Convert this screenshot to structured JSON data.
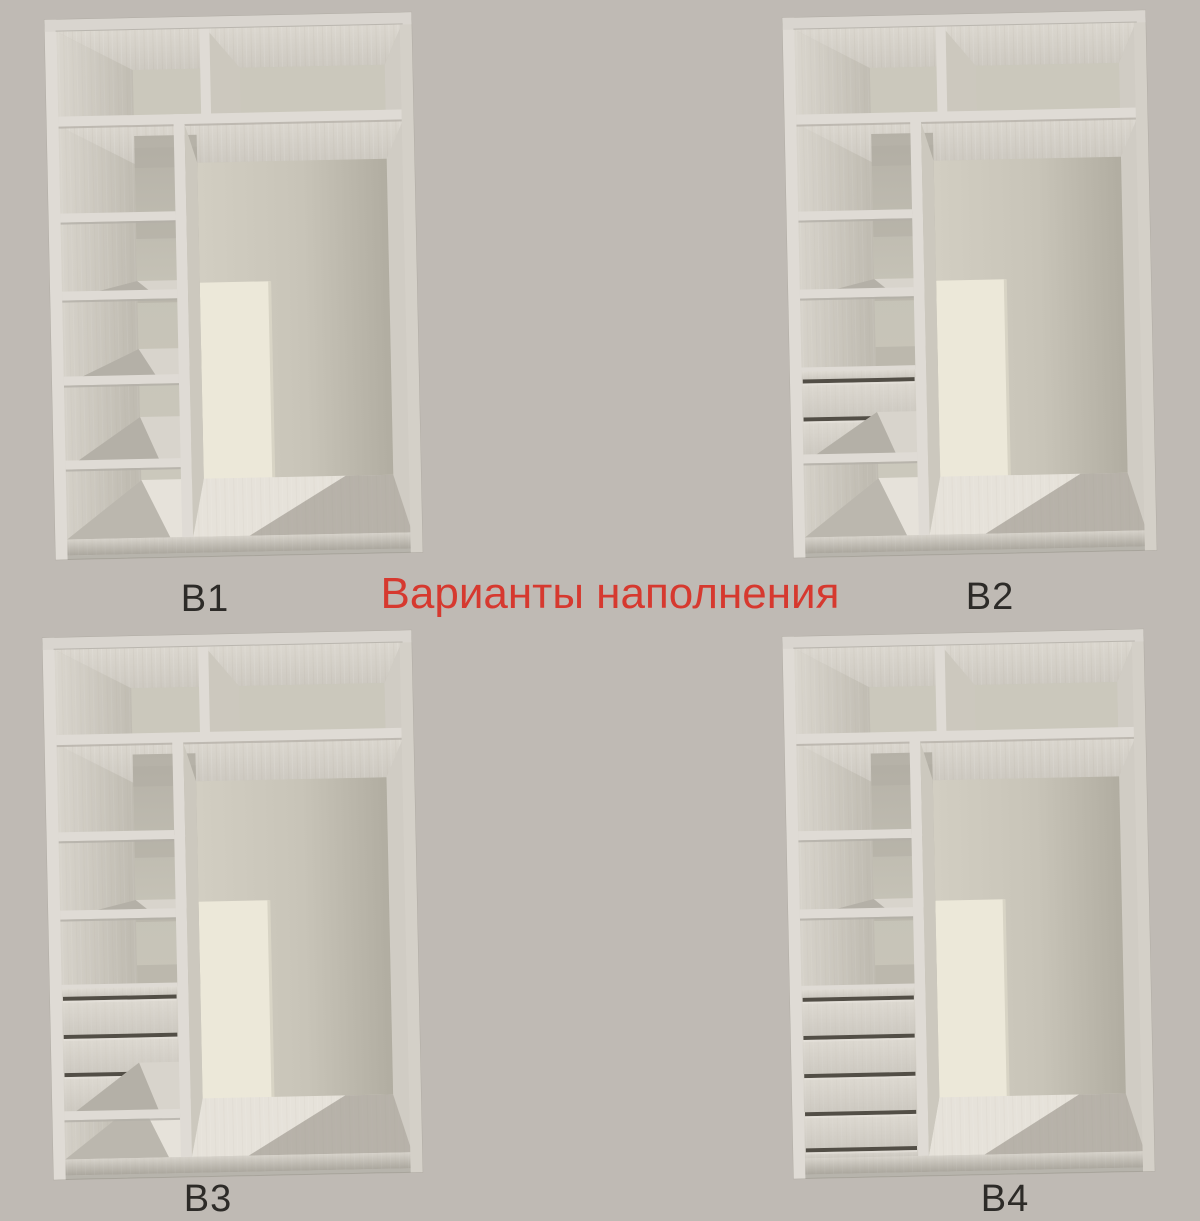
{
  "background": "#bfbab4",
  "title": {
    "text": "Варианты наполнения",
    "color": "#d6392f"
  },
  "label_color": "#2d2b28",
  "palette": {
    "frame": "#d9d5cf",
    "frame_light": "#dfdbd5",
    "frame_edge": "#b0aca4",
    "interior_back": "#c7c4b8",
    "back_top": "#cbc8bc",
    "compartment_back": "#c6c3b7",
    "ceiling_light": "#dbd7cf",
    "ceiling_dark": "#cfcbc3",
    "left_wall_light": "#d8d4cc",
    "left_wall_dark": "#c3bfb5",
    "right_wall": "#d0ccc4",
    "side_face": "#ccc8be",
    "back_right_light": "#d2cec2",
    "back_right_dark": "#b1ada1",
    "panel_cream": "#ece8d9",
    "panel_edge": "#d8d4c5",
    "floor": "#e6e2da",
    "shadow": "#8f8b81",
    "drawer_gap": "#524e46",
    "under_shelf": "#b0aca2",
    "surface": "#d8d4cc"
  },
  "variants": [
    {
      "id": "v1",
      "label": "В1",
      "shelves": [
        200,
        278,
        363,
        447
      ],
      "drawer_block": null
    },
    {
      "id": "v2",
      "label": "В2",
      "shelves": [
        200,
        278
      ],
      "drawer_block": {
        "top": 360,
        "gaps": [
          368,
          406
        ],
        "bottom": 443,
        "shelf_below": true
      }
    },
    {
      "id": "v3",
      "label": "В3",
      "shelves": [
        200,
        278
      ],
      "drawer_block": {
        "top": 356,
        "gaps": [
          364,
          402,
          440
        ],
        "bottom": 478,
        "shelf_below": true
      }
    },
    {
      "id": "v4",
      "label": "В4",
      "shelves": [
        200,
        278
      ],
      "drawer_block": {
        "top": 358,
        "gaps": [
          366,
          404,
          442,
          480,
          516
        ],
        "bottom": 526,
        "shelf_below": false
      }
    }
  ]
}
